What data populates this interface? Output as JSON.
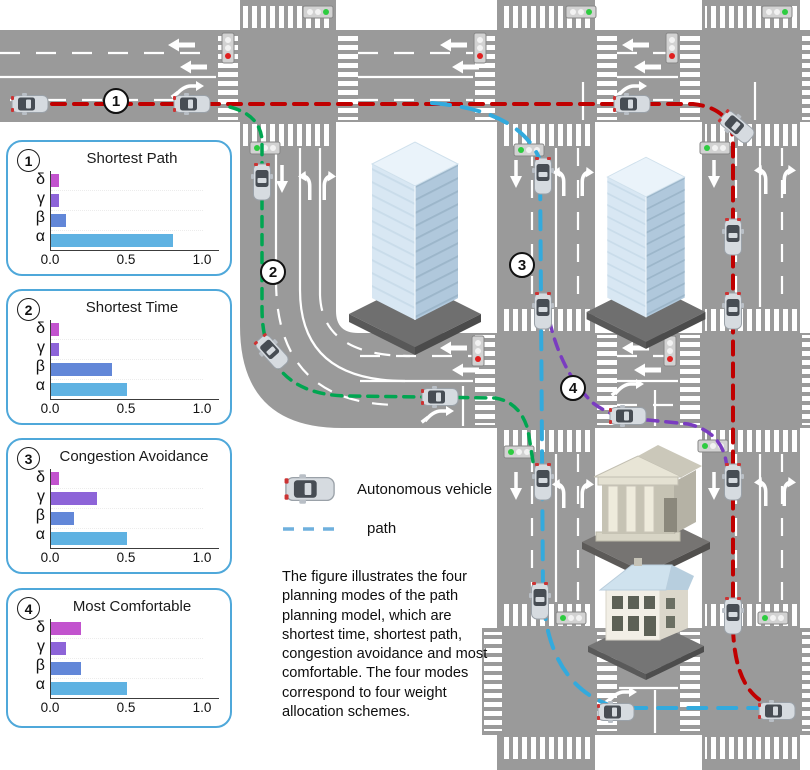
{
  "figure": {
    "legend": {
      "vehicle_label": "Autonomous vehicle",
      "path_label": "path"
    },
    "caption": "The figure illustrates the four planning modes of the path planning model, which are shortest time, shortest path, congestion avoidance and most comfortable. The four modes correspond to four weight allocation schemes.",
    "map_markers": [
      {
        "label": "1"
      },
      {
        "label": "2"
      },
      {
        "label": "3"
      },
      {
        "label": "4"
      }
    ]
  },
  "chart_data": [
    {
      "type": "bar",
      "panel_number": "1",
      "title": "Shortest Path",
      "orientation": "horizontal",
      "categories": [
        "δ",
        "γ",
        "β",
        "α"
      ],
      "values": [
        0.05,
        0.05,
        0.1,
        0.8
      ],
      "xlim": [
        0,
        1.0
      ],
      "xticks": [
        "0.0",
        "0.5",
        "1.0"
      ],
      "bar_colors": [
        "#c253ce",
        "#8d64d8",
        "#6287d8",
        "#5fb2e2"
      ]
    },
    {
      "type": "bar",
      "panel_number": "2",
      "title": "Shortest Time",
      "orientation": "horizontal",
      "categories": [
        "δ",
        "γ",
        "β",
        "α"
      ],
      "values": [
        0.05,
        0.05,
        0.4,
        0.5
      ],
      "xlim": [
        0,
        1.0
      ],
      "xticks": [
        "0.0",
        "0.5",
        "1.0"
      ],
      "bar_colors": [
        "#c253ce",
        "#8d64d8",
        "#6287d8",
        "#5fb2e2"
      ]
    },
    {
      "type": "bar",
      "panel_number": "3",
      "title": "Congestion Avoidance",
      "orientation": "horizontal",
      "categories": [
        "δ",
        "γ",
        "β",
        "α"
      ],
      "values": [
        0.05,
        0.3,
        0.15,
        0.5
      ],
      "xlim": [
        0,
        1.0
      ],
      "xticks": [
        "0.0",
        "0.5",
        "1.0"
      ],
      "bar_colors": [
        "#c253ce",
        "#8d64d8",
        "#6287d8",
        "#5fb2e2"
      ]
    },
    {
      "type": "bar",
      "panel_number": "4",
      "title": "Most Comfortable",
      "orientation": "horizontal",
      "categories": [
        "δ",
        "γ",
        "β",
        "α"
      ],
      "values": [
        0.2,
        0.1,
        0.2,
        0.5
      ],
      "xlim": [
        0,
        1.0
      ],
      "xticks": [
        "0.0",
        "0.5",
        "1.0"
      ],
      "bar_colors": [
        "#c253ce",
        "#8d64d8",
        "#6287d8",
        "#5fb2e2"
      ]
    }
  ],
  "colors": {
    "road": "#9a9a9a",
    "panel_border": "#4fa8da",
    "path_red": "#c00000",
    "path_green": "#00a651",
    "path_blue": "#33aadd",
    "path_purple": "#7a3cc0"
  }
}
